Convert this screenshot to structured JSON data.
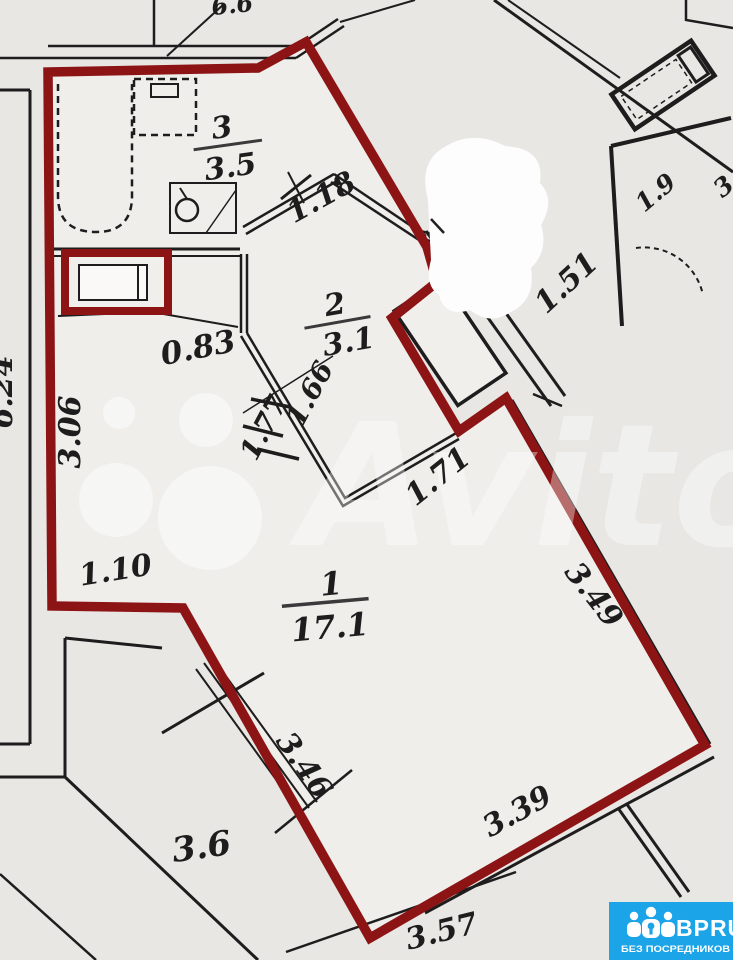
{
  "plan": {
    "rooms": [
      {
        "number": "3",
        "area": "3.5"
      },
      {
        "number": "2",
        "area": "3.1"
      },
      {
        "number": "1",
        "area": "17.1"
      },
      {
        "number": "",
        "area": "3.6"
      }
    ],
    "dimensions": {
      "top_partial": "6.6",
      "d118": "1.18",
      "d151": "1.51",
      "d19": "1.9",
      "d3_partial": "3",
      "d083": "0.83",
      "d166": "1.66",
      "d177": "1.77",
      "d171": "1.71",
      "d306": "3.06",
      "d624": "6.24",
      "d110": "1.10",
      "d349": "3.49",
      "d346": "3.46",
      "d339": "3.39",
      "d357": "3.57"
    }
  },
  "watermark": {
    "text": "Avito"
  },
  "logo": {
    "name": "BPRU",
    "tagline": "БЕЗ ПОСРЕДНИКОВ",
    "bg_color": "#1ba4e7",
    "text_color": "#ffffff"
  },
  "colors": {
    "apartment_boundary": "#8c1414",
    "wall_ink": "#1e1c1c",
    "paper": "#e8e7e4",
    "paper_inner": "#efeeeb",
    "watermark_white": "#ffffff",
    "logo_blue": "#1ba4e7"
  }
}
